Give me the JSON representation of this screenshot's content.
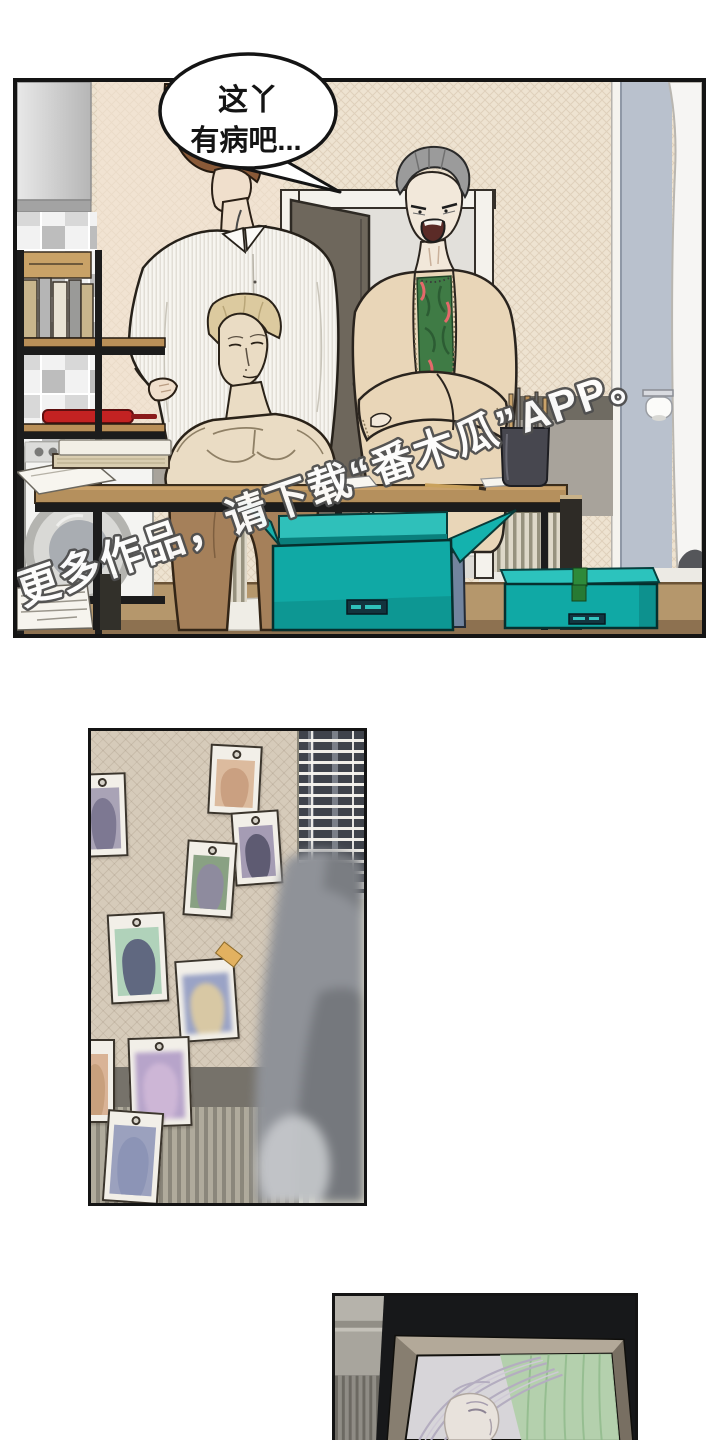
{
  "page": {
    "bg": "#ffffff"
  },
  "panel1": {
    "speech_bubble": {
      "line1": "这丫",
      "line2": "有病吧..."
    },
    "watermark_text": "更多作品，请下载“番木瓜”APP。"
  },
  "panel2": {
    "blinds": {
      "slat_count": 14
    },
    "photos": [
      {
        "x": -12,
        "y": 42,
        "w": 48,
        "h": 84,
        "rot": -2,
        "img": "#a9a3b6",
        "fig": "#7d7892",
        "pin": true,
        "blur": false
      },
      {
        "x": 118,
        "y": 14,
        "w": 52,
        "h": 70,
        "rot": 3,
        "img": "#dcbb9e",
        "fig": "#caa081",
        "pin": true,
        "blur": false
      },
      {
        "x": 142,
        "y": 80,
        "w": 48,
        "h": 74,
        "rot": -4,
        "img": "#a59cb4",
        "fig": "#5e5b72",
        "pin": true,
        "blur": false
      },
      {
        "x": 94,
        "y": 110,
        "w": 50,
        "h": 76,
        "rot": 4,
        "img": "#89a183",
        "fig": "#8e8b9e",
        "pin": true,
        "blur": false
      },
      {
        "x": 18,
        "y": 182,
        "w": 58,
        "h": 90,
        "rot": -3,
        "img": "#b0d2ba",
        "fig": "#606880",
        "pin": true,
        "blur": false
      },
      {
        "x": 86,
        "y": 228,
        "w": 60,
        "h": 82,
        "rot": -4,
        "img": "#9aa3c6",
        "fig": "#d8c8a4",
        "pin": false,
        "blur": true
      },
      {
        "x": -16,
        "y": 308,
        "w": 40,
        "h": 84,
        "rot": 0,
        "img": "#d9b396",
        "fig": "#c8a07d",
        "pin": false,
        "blur": false
      },
      {
        "x": 38,
        "y": 306,
        "w": 62,
        "h": 90,
        "rot": -2,
        "img": "#b7a4ca",
        "fig": "#cdb6d6",
        "pin": true,
        "blur": true
      },
      {
        "x": 14,
        "y": 380,
        "w": 56,
        "h": 92,
        "rot": 4,
        "img": "#9ba1be",
        "fig": "#8c94b6",
        "pin": true,
        "blur": false
      }
    ],
    "tape": {
      "x": 126,
      "y": 216,
      "w": 24,
      "h": 15,
      "rot": 38,
      "color": "#e2b160"
    }
  },
  "colors": {
    "ink": "#141414",
    "pageBg": "#ffffff",
    "wallCream": "#eee3d1",
    "wallPink": "#f4e4d4",
    "band": "#6f6b62",
    "bandLight": "#a8a39b",
    "doorWood": "#6e675c",
    "frameWhite": "#f4f2ec",
    "opening": "#dcdad5",
    "blueWall": "#b9c1cd",
    "fridge": "#f6f5f3",
    "hairBrown": "#8a5a38",
    "hairGray": "#9b9b9b",
    "hairBlond": "#dcca9f",
    "skin": "#f0dfcc",
    "skin2": "#f2e8da",
    "bustSkin": "#eadcc4",
    "cardigan": "#e9d6b8",
    "shirtGreen": "#3f7b45",
    "shirtRed": "#e4696b",
    "jeans": "#72849e",
    "pants": "#a5805a",
    "belt": "#4d3a28",
    "tableWood": "#b5905d",
    "floorWood": "#b5976c",
    "teal": "#10a9a5",
    "tealLight": "#2fc0ba",
    "tealTop": "#2cc3bd",
    "tealDark": "#0a7f7c",
    "tapeGreen": "#2e8a3a",
    "panRed": "#c32222",
    "washer": "#f4f4f2",
    "p2Wall": "#d6cbba",
    "p2Band": "#76726a",
    "slat": "#3f434b",
    "figureGray": "#8f9298",
    "figureDark": "#75787d",
    "photoFrame": "#f2efe8",
    "photoOutline": "#3b352c",
    "p3Bg": "#17181a",
    "p3Frame": "#998f82",
    "p3Canvas": "#d7d5d9",
    "p3Green": "#b1cfa9",
    "wmFill": "#ffffff",
    "wmStroke": "#4e4e4e"
  }
}
